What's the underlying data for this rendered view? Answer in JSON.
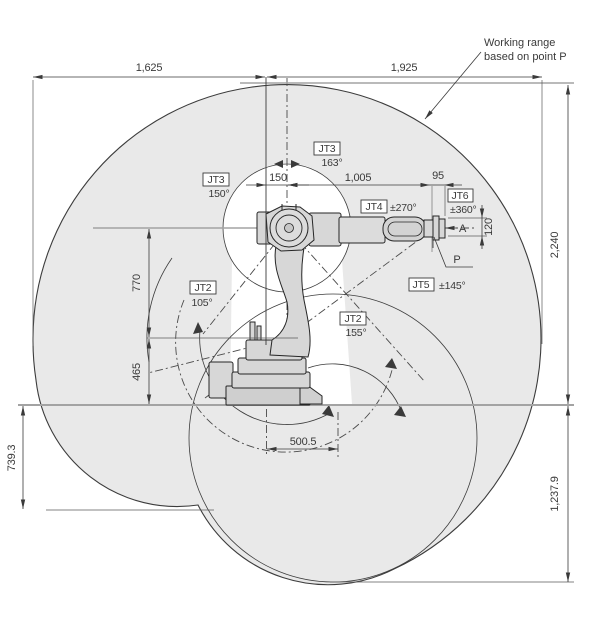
{
  "note": {
    "line1": "Working range",
    "line2": "based on point P"
  },
  "dims": {
    "reach_left": "1,625",
    "reach_right": "1,925",
    "total_height": "2,240",
    "below_ground_right": "1,237.9",
    "below_ground_left": "739.3",
    "lower_arm": "770",
    "base_to_jt2": "465",
    "jt1_offset": "150",
    "upper_arm": "1,005",
    "wrist_to_flange": "95",
    "flange_width": "120",
    "base_span": "500.5"
  },
  "joint_labels": [
    {
      "name": "JT3",
      "angle": "150°"
    },
    {
      "name": "JT3",
      "angle": "163°"
    },
    {
      "name": "JT4",
      "angle": "±270°"
    },
    {
      "name": "JT6",
      "angle": "±360°"
    },
    {
      "name": "JT5",
      "angle": "±145°"
    },
    {
      "name": "JT2",
      "angle": "105°"
    },
    {
      "name": "JT2",
      "angle": "155°"
    }
  ],
  "points": {
    "flange_view": "A",
    "wrist_point": "P"
  },
  "colors": {
    "envelope_fill": "#e9e9e9",
    "robot_fill": "#d7d7d7",
    "line": "#3a3a3a",
    "gray_ref": "#a3a3a3"
  }
}
